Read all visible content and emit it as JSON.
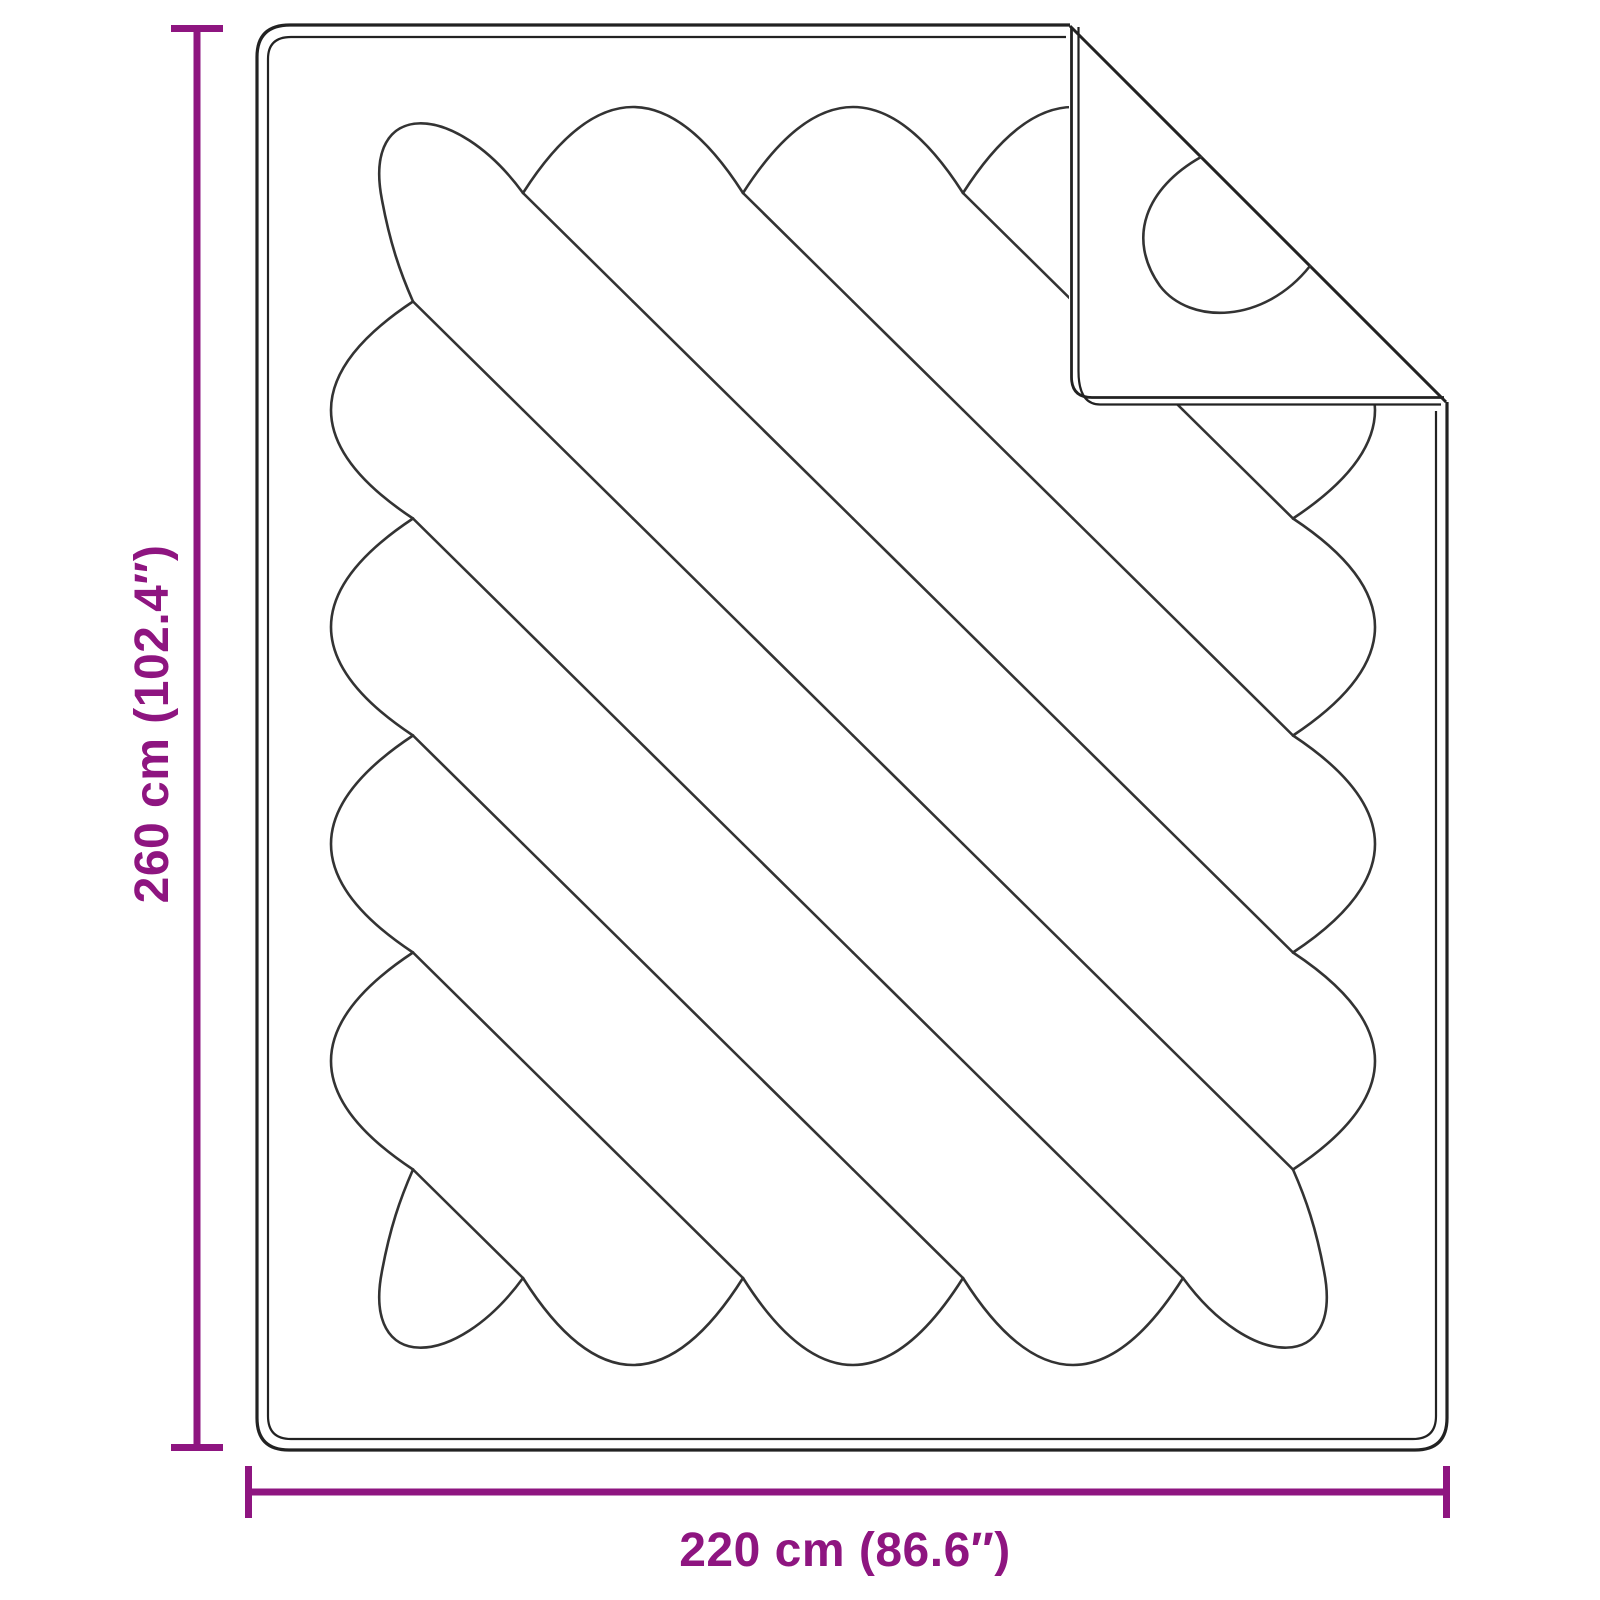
{
  "diagram": {
    "title": "quilted-blanket-dimension-diagram",
    "labels": {
      "height": "260 cm (102.4″)",
      "width": "220 cm (86.6″)"
    },
    "colors": {
      "dimension": "#8E1580",
      "outline": "#222222",
      "stitch": "#333333",
      "background": "#ffffff"
    }
  }
}
